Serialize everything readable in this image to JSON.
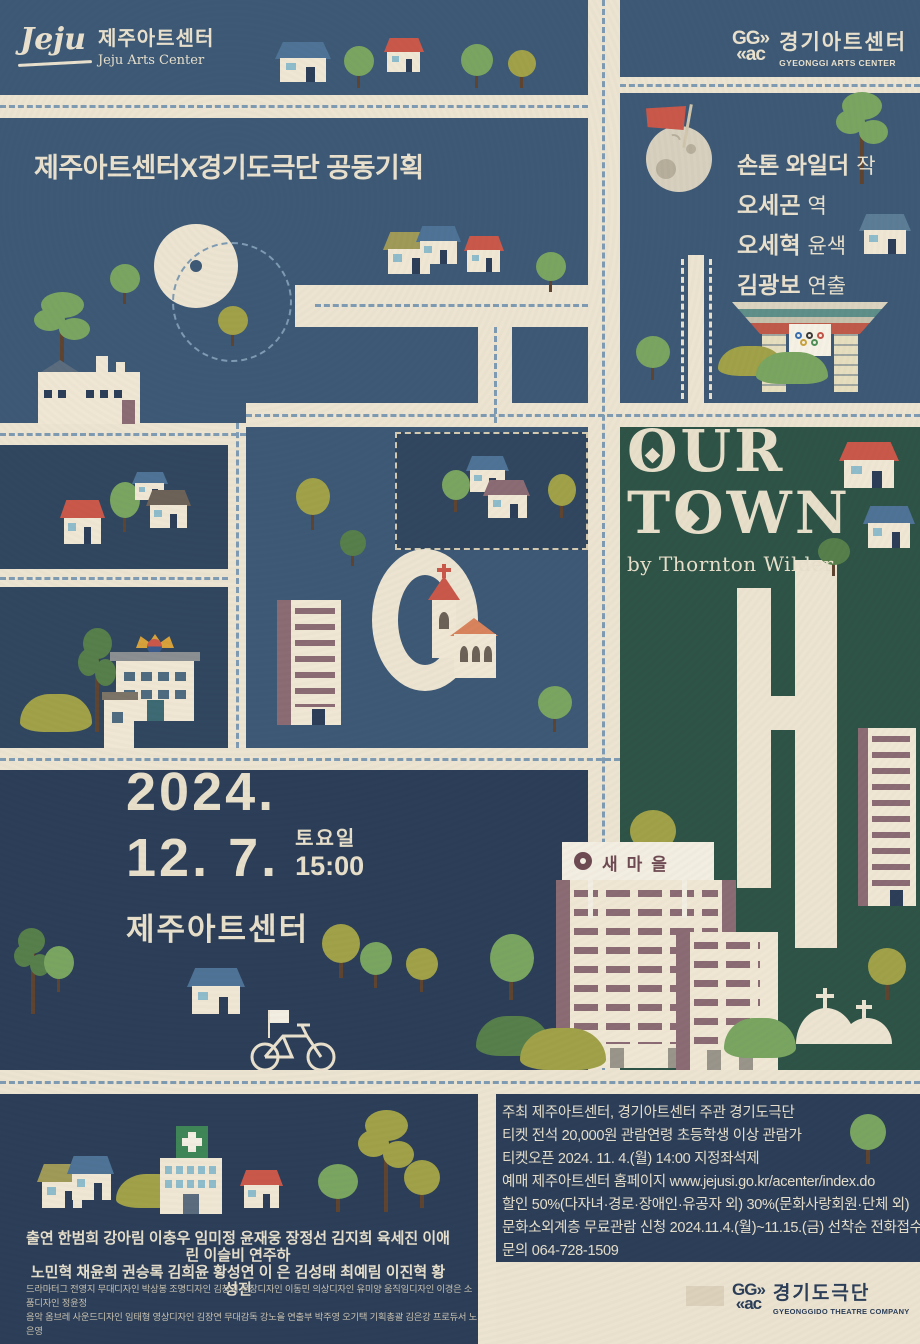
{
  "colors": {
    "paper": "#ebe3d0",
    "road": "#ece4d1",
    "creamDim": "#dcd2bb",
    "cream": "#e9e1cd",
    "navy": "#3d5976",
    "navy2": "#31475f",
    "navy3": "#2c3e58",
    "green": "#2e5347",
    "dash": "#7e9bb3",
    "red": "#c9584a",
    "blue": "#4e7396",
    "slate": "#5c7d96",
    "olive": "#a0a148",
    "oliveRoof": "#a09a58",
    "brown": "#6d6257",
    "mauve": "#8b6b74",
    "gold": "#d7a13b",
    "treeGreen": "#79a561",
    "treeDark": "#567f4b",
    "trunk": "#5f4430",
    "moon": "#d7d0be",
    "moonSpot": "#b7af9c",
    "white": "#f3eee2",
    "signBrown": "#6e4a52",
    "body": "#efe7d4",
    "windowBlue": "#8fbccb",
    "gray": "#8b8f92",
    "crossGreen": "#3f8657",
    "teal": "#5f8f89",
    "terra": "#bf5a4a"
  },
  "header": {
    "jeju": {
      "script": "Jeju",
      "kr": "제주아트센터",
      "en": "Jeju Arts Center"
    },
    "ggac": {
      "mark_top": "GG»",
      "mark_bottom": "«ac",
      "kr": "경기아트센터",
      "en": "GYEONGGI ARTS CENTER"
    }
  },
  "plan_note": "제주아트센터X경기도극단 공동기획",
  "credits": [
    {
      "name": "손톤 와일더",
      "role": "작"
    },
    {
      "name": "오세곤",
      "role": "역"
    },
    {
      "name": "오세혁",
      "role": "윤색"
    },
    {
      "name": "김광보",
      "role": "연출"
    }
  ],
  "title": {
    "line1": "OUR",
    "line2": "TOWN",
    "byline": "by Thornton Wilder"
  },
  "schedule": {
    "year": "2024.",
    "date": "12. 7.",
    "day": "토요일",
    "time": "15:00",
    "venue": "제주아트센터"
  },
  "map_labels": {
    "saemaul_sign": "새마을"
  },
  "info": {
    "lines": [
      "주최 제주아트센터, 경기아트센터   주관 경기도극단",
      "티켓 전석 20,000원   관람연령 초등학생 이상 관람가",
      "티켓오픈 2024. 11. 4.(월) 14:00 지정좌석제",
      "예매 제주아트센터 홈페이지 www.jejusi.go.kr/acenter/index.do",
      "할인 50%(다자녀·경로·장애인·유공자 외) 30%(문화사랑회원·단체 외)",
      "문화소외계층 무료관람 신청 2024.11.4.(월)~11.15.(금) 선착순 전화접수",
      "문의 064-728-1509"
    ]
  },
  "cast": {
    "line1": "출연 한범희 강아림 이충우 임미정 윤재웅 장정선 김지희 육세진 이애린 이슬비 연주하",
    "line2": "노민혁 채윤희 권승록 김희윤 황성연 이 은 김성태 최예림 이진혁 황성진"
  },
  "staff": {
    "line1": "드라마터그 전영지 무대디자인 박상봉 조명디자인 김창기 분장디자인 이동민 의상디자인 유미양 움직임디자인 이경은 소품디자인 정윤정",
    "line2": "음악 옴브레 사운드디자인 임태형 영상디자인 김장연 무대감독 강노을 연출부 박주영 오기택 기획총괄 김은강 프로듀서 노은영"
  },
  "footer": {
    "ggtc": {
      "mark_top": "GG»",
      "mark_bottom": "«ac",
      "kr": "경기도극단",
      "en": "GYEONGGIDO THEATRE COMPANY"
    }
  },
  "scenery": [
    {
      "t": "panel",
      "x": 0,
      "y": 0,
      "w": 588,
      "h": 95,
      "c": "navy"
    },
    {
      "t": "panel",
      "x": 620,
      "y": 0,
      "w": 300,
      "h": 77,
      "c": "navy"
    },
    {
      "t": "panel",
      "x": 620,
      "y": 93,
      "w": 300,
      "h": 310,
      "c": "navy"
    },
    {
      "t": "panel",
      "x": 0,
      "y": 118,
      "w": 588,
      "h": 305,
      "c": "navy"
    },
    {
      "t": "panel",
      "x": 620,
      "y": 427,
      "w": 300,
      "h": 643,
      "c": "green"
    },
    {
      "t": "panel",
      "x": 246,
      "y": 427,
      "w": 342,
      "h": 321,
      "c": "navy"
    },
    {
      "t": "panel",
      "x": 0,
      "y": 445,
      "w": 228,
      "h": 124,
      "c": "navy2"
    },
    {
      "t": "panel",
      "x": 0,
      "y": 587,
      "w": 228,
      "h": 161,
      "c": "navy2"
    },
    {
      "t": "panel",
      "x": 0,
      "y": 770,
      "w": 588,
      "h": 300,
      "c": "navy3"
    },
    {
      "t": "panel",
      "x": 0,
      "y": 1094,
      "w": 478,
      "h": 250,
      "c": "navy3"
    },
    {
      "t": "panel",
      "x": 496,
      "y": 1094,
      "w": 424,
      "h": 168,
      "c": "navy3"
    },
    {
      "t": "panel",
      "x": 395,
      "y": 432,
      "w": 193,
      "h": 118,
      "c": "navy2",
      "dashed": true
    },
    {
      "t": "road",
      "x": 588,
      "y": 0,
      "w": 32,
      "h": 1070
    },
    {
      "t": "road",
      "x": 0,
      "y": 95,
      "w": 588,
      "h": 23
    },
    {
      "t": "road",
      "x": 620,
      "y": 77,
      "w": 300,
      "h": 16
    },
    {
      "t": "road",
      "x": 246,
      "y": 403,
      "w": 674,
      "h": 24
    },
    {
      "t": "road",
      "x": 0,
      "y": 423,
      "w": 246,
      "h": 22
    },
    {
      "t": "road",
      "x": 228,
      "y": 423,
      "w": 18,
      "h": 325
    },
    {
      "t": "road",
      "x": 0,
      "y": 569,
      "w": 228,
      "h": 18
    },
    {
      "t": "road",
      "x": 0,
      "y": 748,
      "w": 620,
      "h": 22
    },
    {
      "t": "road",
      "x": 0,
      "y": 1070,
      "w": 920,
      "h": 24
    },
    {
      "t": "road",
      "x": 478,
      "y": 1094,
      "w": 18,
      "h": 250
    },
    {
      "t": "road",
      "x": 688,
      "y": 255,
      "w": 16,
      "h": 148
    },
    {
      "t": "road",
      "x": 295,
      "y": 285,
      "w": 293,
      "h": 42
    },
    {
      "t": "road",
      "x": 478,
      "y": 285,
      "w": 34,
      "h": 140
    },
    {
      "t": "road",
      "x": 686,
      "y": 1286,
      "w": 38,
      "h": 20,
      "c": "creamDim"
    },
    {
      "t": "bar",
      "x": 737,
      "y": 588,
      "w": 34,
      "h": 300
    },
    {
      "t": "bar",
      "x": 795,
      "y": 560,
      "w": 42,
      "h": 388
    },
    {
      "t": "bar",
      "x": 737,
      "y": 696,
      "w": 100,
      "h": 34
    },
    {
      "t": "ring",
      "x": 154,
      "y": 224,
      "w": 156,
      "h": 156,
      "bw": 36
    },
    {
      "t": "ring",
      "x": 372,
      "y": 549,
      "w": 158,
      "h": 194,
      "bw": 26
    },
    {
      "t": "dashh",
      "x": 0,
      "y": 105,
      "len": 588
    },
    {
      "t": "dashh",
      "x": 620,
      "y": 84,
      "len": 300
    },
    {
      "t": "dashv",
      "x": 602,
      "y": 0,
      "len": 1070
    },
    {
      "t": "dashh",
      "x": 246,
      "y": 414,
      "len": 674
    },
    {
      "t": "dashh",
      "x": 0,
      "y": 433,
      "len": 246
    },
    {
      "t": "dashv",
      "x": 236,
      "y": 423,
      "len": 325
    },
    {
      "t": "dashh",
      "x": 0,
      "y": 577,
      "len": 228
    },
    {
      "t": "dashh",
      "x": 0,
      "y": 758,
      "len": 620
    },
    {
      "t": "dashh",
      "x": 0,
      "y": 1081,
      "len": 920
    },
    {
      "t": "dashh",
      "x": 315,
      "y": 304,
      "len": 273
    },
    {
      "t": "dashv",
      "x": 494,
      "y": 327,
      "len": 96
    },
    {
      "t": "dashv",
      "x": 681,
      "y": 259,
      "len": 140,
      "c": "cream"
    },
    {
      "t": "dashv",
      "x": 709,
      "y": 259,
      "len": 140,
      "c": "cream"
    },
    {
      "t": "dashring",
      "x": 172,
      "y": 242,
      "w": 120,
      "h": 120
    },
    {
      "t": "house",
      "x": 278,
      "y": 42,
      "w": 50,
      "h": 40,
      "roof": "blue"
    },
    {
      "t": "tree",
      "x": 344,
      "y": 46,
      "w": 30,
      "h": 42,
      "c": "treeGreen"
    },
    {
      "t": "house",
      "x": 386,
      "y": 38,
      "w": 36,
      "h": 34,
      "roof": "red"
    },
    {
      "t": "tree",
      "x": 461,
      "y": 44,
      "w": 32,
      "h": 44,
      "c": "treeGreen"
    },
    {
      "t": "tree",
      "x": 508,
      "y": 50,
      "w": 28,
      "h": 38,
      "c": "olive"
    },
    {
      "t": "moon",
      "x": 646,
      "y": 126,
      "s": 66
    },
    {
      "t": "flag",
      "x": 646,
      "y": 104
    },
    {
      "t": "pine",
      "x": 836,
      "y": 92,
      "w": 52,
      "h": 92,
      "c": "treeGreen"
    },
    {
      "t": "house",
      "x": 862,
      "y": 214,
      "w": 46,
      "h": 40,
      "roof": "slate"
    },
    {
      "t": "gate",
      "x": 732,
      "y": 298
    },
    {
      "t": "tree",
      "x": 636,
      "y": 336,
      "w": 34,
      "h": 44,
      "c": "treeGreen"
    },
    {
      "t": "bush",
      "x": 718,
      "y": 346,
      "w": 66,
      "h": 30,
      "c": "olive"
    },
    {
      "t": "bush",
      "x": 756,
      "y": 352,
      "w": 72,
      "h": 32,
      "c": "treeGreen"
    },
    {
      "t": "pine",
      "x": 34,
      "y": 292,
      "w": 56,
      "h": 86,
      "c": "treeGreen"
    },
    {
      "t": "tree",
      "x": 110,
      "y": 264,
      "w": 30,
      "h": 40,
      "c": "treeGreen"
    },
    {
      "t": "factory",
      "x": 38,
      "y": 352
    },
    {
      "t": "tree",
      "x": 218,
      "y": 306,
      "w": 30,
      "h": 40,
      "c": "olive"
    },
    {
      "t": "house",
      "x": 386,
      "y": 232,
      "w": 46,
      "h": 42,
      "roof": "oliveRoof"
    },
    {
      "t": "house",
      "x": 418,
      "y": 226,
      "w": 40,
      "h": 38,
      "roof": "blue"
    },
    {
      "t": "house",
      "x": 466,
      "y": 236,
      "w": 36,
      "h": 36,
      "roof": "red"
    },
    {
      "t": "tree",
      "x": 536,
      "y": 252,
      "w": 30,
      "h": 40,
      "c": "treeGreen"
    },
    {
      "t": "house",
      "x": 468,
      "y": 456,
      "w": 38,
      "h": 36,
      "roof": "blue"
    },
    {
      "t": "house",
      "x": 486,
      "y": 480,
      "w": 42,
      "h": 38,
      "roof": "mauve"
    },
    {
      "t": "tree",
      "x": 442,
      "y": 470,
      "w": 28,
      "h": 42,
      "c": "treeGreen"
    },
    {
      "t": "tree",
      "x": 548,
      "y": 474,
      "w": 28,
      "h": 44,
      "c": "olive"
    },
    {
      "t": "house",
      "x": 62,
      "y": 500,
      "w": 40,
      "h": 44,
      "roof": "red"
    },
    {
      "t": "tree",
      "x": 110,
      "y": 482,
      "w": 30,
      "h": 50,
      "c": "treeGreen"
    },
    {
      "t": "house",
      "x": 134,
      "y": 472,
      "w": 32,
      "h": 28,
      "roof": "blue"
    },
    {
      "t": "house",
      "x": 148,
      "y": 490,
      "w": 40,
      "h": 38,
      "roof": "brown"
    },
    {
      "t": "bush",
      "x": 20,
      "y": 694,
      "w": 72,
      "h": 38,
      "c": "olive"
    },
    {
      "t": "pine",
      "x": 78,
      "y": 628,
      "w": 38,
      "h": 104,
      "c": "treeDark"
    },
    {
      "t": "cityhall",
      "x": 102,
      "y": 634
    },
    {
      "t": "tree",
      "x": 296,
      "y": 478,
      "w": 34,
      "h": 52,
      "c": "olive"
    },
    {
      "t": "tree",
      "x": 340,
      "y": 530,
      "w": 26,
      "h": 36,
      "c": "treeDark"
    },
    {
      "t": "apartment",
      "x": 277,
      "y": 600,
      "w": 64,
      "h": 125,
      "col": 14
    },
    {
      "t": "church",
      "x": 402,
      "y": 564
    },
    {
      "t": "tree",
      "x": 538,
      "y": 686,
      "w": 34,
      "h": 46,
      "c": "treeGreen"
    },
    {
      "t": "house",
      "x": 842,
      "y": 442,
      "w": 54,
      "h": 46,
      "roof": "red"
    },
    {
      "t": "house",
      "x": 866,
      "y": 506,
      "w": 46,
      "h": 42,
      "roof": "blue"
    },
    {
      "t": "tree",
      "x": 818,
      "y": 538,
      "w": 32,
      "h": 38,
      "c": "treeDark"
    },
    {
      "t": "tree",
      "x": 630,
      "y": 810,
      "w": 46,
      "h": 58,
      "c": "olive"
    },
    {
      "t": "apartment",
      "x": 858,
      "y": 728,
      "w": 58,
      "h": 178,
      "col": 10
    },
    {
      "t": "tree",
      "x": 490,
      "y": 934,
      "w": 44,
      "h": 66,
      "c": "treeGreen"
    },
    {
      "t": "aptblock",
      "x": 556,
      "y": 880,
      "w": 180,
      "h": 188,
      "cols": 2
    },
    {
      "t": "aptblock",
      "x": 676,
      "y": 932,
      "w": 102,
      "h": 138,
      "cols": 1
    },
    {
      "t": "sign",
      "x": 562,
      "y": 842
    },
    {
      "t": "bush",
      "x": 476,
      "y": 1016,
      "w": 74,
      "h": 40,
      "c": "treeDark"
    },
    {
      "t": "bush",
      "x": 520,
      "y": 1028,
      "w": 86,
      "h": 42,
      "c": "olive"
    },
    {
      "t": "bush",
      "x": 724,
      "y": 1018,
      "w": 72,
      "h": 40,
      "c": "treeGreen"
    },
    {
      "t": "graves",
      "x": 796,
      "y": 988
    },
    {
      "t": "tree",
      "x": 868,
      "y": 948,
      "w": 38,
      "h": 52,
      "c": "olive"
    },
    {
      "t": "pine",
      "x": 14,
      "y": 928,
      "w": 36,
      "h": 86,
      "c": "treeDark"
    },
    {
      "t": "tree",
      "x": 44,
      "y": 946,
      "w": 30,
      "h": 46,
      "c": "treeGreen"
    },
    {
      "t": "house",
      "x": 190,
      "y": 968,
      "w": 52,
      "h": 46,
      "roof": "blue"
    },
    {
      "t": "tree",
      "x": 322,
      "y": 924,
      "w": 38,
      "h": 54,
      "c": "olive"
    },
    {
      "t": "tree",
      "x": 360,
      "y": 942,
      "w": 32,
      "h": 46,
      "c": "treeGreen"
    },
    {
      "t": "tree",
      "x": 406,
      "y": 948,
      "w": 32,
      "h": 44,
      "c": "olive"
    },
    {
      "t": "bike",
      "x": 246,
      "y": 1008
    },
    {
      "t": "house",
      "x": 40,
      "y": 1164,
      "w": 44,
      "h": 44,
      "roof": "oliveRoof"
    },
    {
      "t": "house",
      "x": 70,
      "y": 1156,
      "w": 42,
      "h": 44,
      "roof": "blue"
    },
    {
      "t": "bush",
      "x": 116,
      "y": 1174,
      "w": 72,
      "h": 34,
      "c": "olive"
    },
    {
      "t": "hospital",
      "x": 160,
      "y": 1126
    },
    {
      "t": "house",
      "x": 242,
      "y": 1170,
      "w": 38,
      "h": 38,
      "roof": "red"
    },
    {
      "t": "tree",
      "x": 318,
      "y": 1164,
      "w": 40,
      "h": 48,
      "c": "treeGreen"
    },
    {
      "t": "pine",
      "x": 358,
      "y": 1110,
      "w": 56,
      "h": 102,
      "c": "olive"
    },
    {
      "t": "tree",
      "x": 404,
      "y": 1160,
      "w": 36,
      "h": 48,
      "c": "olive"
    },
    {
      "t": "tree",
      "x": 850,
      "y": 1114,
      "w": 36,
      "h": 50,
      "c": "treeGreen"
    }
  ]
}
